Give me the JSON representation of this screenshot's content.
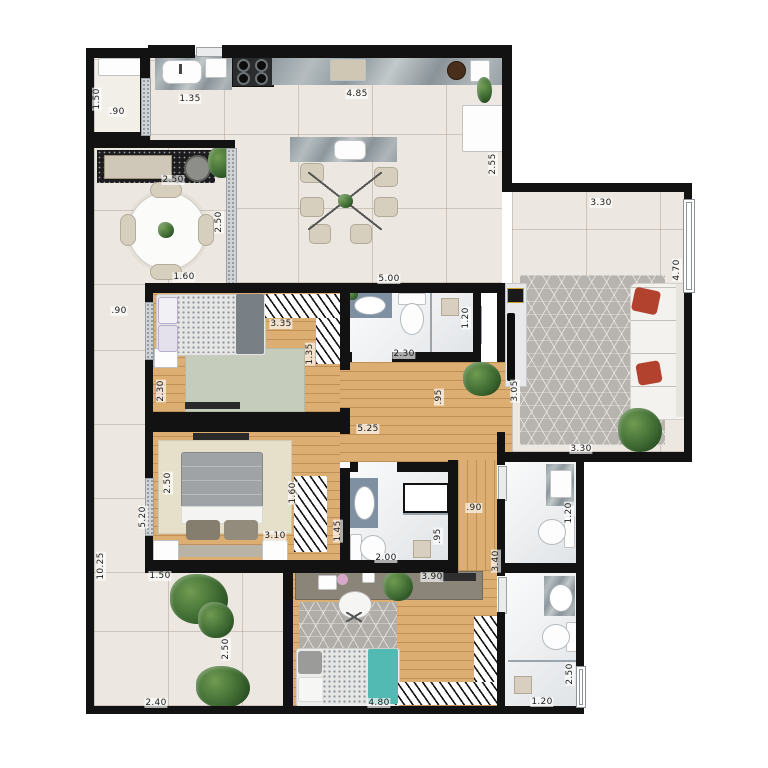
{
  "colors": {
    "wall": "#121212",
    "floorTile": "#ece7e0",
    "wood": "#ddae72",
    "bathFloor": "#eef0f1",
    "graniteDark": "#1c1c1e",
    "counterBlue": "#7e90a1",
    "sofaWhite": "#f3f2ee",
    "pillowRed": "#b2422e",
    "rugLiving": "#b7b3ae",
    "rugGreen": "#c6ccbb",
    "rugBeige": "#e6dfc9",
    "rugBed3": "#b0aca7",
    "bedGray": "#9fa3a6",
    "throwTeal": "#52b9b3",
    "chairBeige": "#d6cfbd",
    "plantGreen": "#3f6b33",
    "labelColor": "#1a1a1a",
    "goldAccent": "#c9a227"
  },
  "dimensions": [
    {
      "text": ".90",
      "x": 117,
      "y": 112,
      "vertical": false
    },
    {
      "text": "1.50",
      "x": 97,
      "y": 99,
      "vertical": true
    },
    {
      "text": "1.35",
      "x": 190,
      "y": 99,
      "vertical": false
    },
    {
      "text": "4.85",
      "x": 357,
      "y": 94,
      "vertical": false
    },
    {
      "text": "2.55",
      "x": 493,
      "y": 164,
      "vertical": true
    },
    {
      "text": "2.50",
      "x": 173,
      "y": 180,
      "vertical": false
    },
    {
      "text": "2.50",
      "x": 219,
      "y": 222,
      "vertical": true
    },
    {
      "text": "1.60",
      "x": 184,
      "y": 277,
      "vertical": false
    },
    {
      "text": ".90",
      "x": 119,
      "y": 311,
      "vertical": false
    },
    {
      "text": "10.25",
      "x": 101,
      "y": 566,
      "vertical": true
    },
    {
      "text": "3.35",
      "x": 281,
      "y": 324,
      "vertical": false
    },
    {
      "text": "1.35",
      "x": 310,
      "y": 354,
      "vertical": true
    },
    {
      "text": "2.30",
      "x": 161,
      "y": 391,
      "vertical": true
    },
    {
      "text": "5.00",
      "x": 389,
      "y": 279,
      "vertical": false
    },
    {
      "text": "2.30",
      "x": 404,
      "y": 354,
      "vertical": false
    },
    {
      "text": "1.20",
      "x": 466,
      "y": 318,
      "vertical": true
    },
    {
      "text": "5.25",
      "x": 368,
      "y": 429,
      "vertical": false
    },
    {
      "text": ".95",
      "x": 439,
      "y": 397,
      "vertical": true
    },
    {
      "text": "3.05",
      "x": 515,
      "y": 391,
      "vertical": true
    },
    {
      "text": "3.30",
      "x": 601,
      "y": 203,
      "vertical": false
    },
    {
      "text": "4.70",
      "x": 677,
      "y": 270,
      "vertical": true
    },
    {
      "text": "2.50",
      "x": 168,
      "y": 483,
      "vertical": true
    },
    {
      "text": "5.20",
      "x": 143,
      "y": 517,
      "vertical": true
    },
    {
      "text": "1.60",
      "x": 293,
      "y": 493,
      "vertical": true
    },
    {
      "text": "3.10",
      "x": 275,
      "y": 536,
      "vertical": false
    },
    {
      "text": "1.45",
      "x": 338,
      "y": 531,
      "vertical": true
    },
    {
      "text": "2.00",
      "x": 386,
      "y": 558,
      "vertical": false
    },
    {
      "text": ".95",
      "x": 438,
      "y": 536,
      "vertical": true
    },
    {
      "text": ".90",
      "x": 474,
      "y": 508,
      "vertical": false
    },
    {
      "text": "3.40",
      "x": 496,
      "y": 561,
      "vertical": true
    },
    {
      "text": "3.90",
      "x": 432,
      "y": 577,
      "vertical": false
    },
    {
      "text": "3.30",
      "x": 581,
      "y": 449,
      "vertical": false
    },
    {
      "text": "1.20",
      "x": 569,
      "y": 513,
      "vertical": true
    },
    {
      "text": "1.50",
      "x": 160,
      "y": 576,
      "vertical": false
    },
    {
      "text": "2.50",
      "x": 226,
      "y": 649,
      "vertical": true
    },
    {
      "text": "2.40",
      "x": 156,
      "y": 703,
      "vertical": false
    },
    {
      "text": "4.80",
      "x": 379,
      "y": 703,
      "vertical": false
    },
    {
      "text": "2.50",
      "x": 570,
      "y": 674,
      "vertical": true
    },
    {
      "text": "1.20",
      "x": 542,
      "y": 702,
      "vertical": false
    }
  ]
}
